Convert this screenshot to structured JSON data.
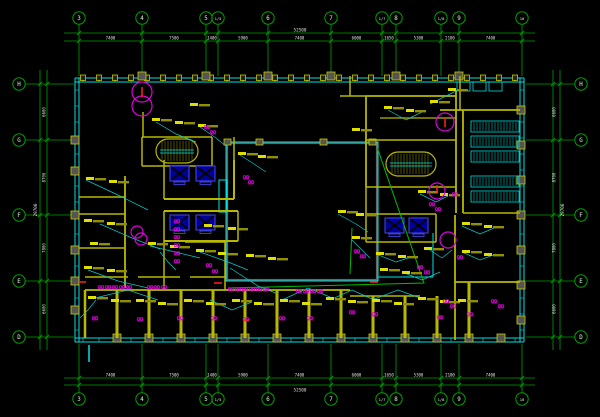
{
  "meta": {
    "title": "electrical-floor-plan",
    "width": 600,
    "height": 417
  },
  "colors": {
    "bg": "#000000",
    "grid": "#00a000",
    "bubble_text": "#ccffcc",
    "dim_text": "#e0e0e0",
    "wall": "#b8b800",
    "wall_bright": "#e0e000",
    "cyan": "#00e0e0",
    "magenta": "#e000e0",
    "blue": "#4848e8",
    "dark_blue": "#000099",
    "red": "#ff2222",
    "gray": "#666666",
    "green": "#00bb00",
    "tag": "#e0e000",
    "tag_dim": "#909000"
  },
  "grid": {
    "top_y": 18,
    "bottom_y": 399,
    "left_x": 19,
    "right_x": 581,
    "cols": [
      [
        "3",
        79
      ],
      [
        "4",
        142
      ],
      [
        "5",
        206
      ],
      [
        "1/5",
        218
      ],
      [
        "6",
        268
      ],
      [
        "7",
        331
      ],
      [
        "1/7",
        382
      ],
      [
        "8",
        396
      ],
      [
        "1/8",
        441
      ],
      [
        "9",
        459
      ],
      [
        "10",
        522
      ]
    ],
    "rows": [
      [
        "H",
        84
      ],
      [
        "G",
        140
      ],
      [
        "F",
        215
      ],
      [
        "E",
        281
      ],
      [
        "D",
        337
      ]
    ]
  },
  "dimensions": {
    "top_overall": "52500",
    "bottom_overall": "52500",
    "side_overall": "29700",
    "col_segments": [
      [
        "7400",
        79,
        142
      ],
      [
        "7500",
        142,
        206
      ],
      [
        "1400",
        206,
        218
      ],
      [
        "5900",
        218,
        268
      ],
      [
        "7400",
        268,
        331
      ],
      [
        "6000",
        331,
        382
      ],
      [
        "1650",
        382,
        396
      ],
      [
        "5300",
        396,
        441
      ],
      [
        "2100",
        441,
        459
      ],
      [
        "7400",
        459,
        522
      ]
    ],
    "row_segments": [
      [
        "6600",
        84,
        140
      ],
      [
        "8700",
        140,
        215
      ],
      [
        "7800",
        215,
        281
      ],
      [
        "6600",
        281,
        337
      ]
    ]
  },
  "building": {
    "outline": {
      "x1": 75,
      "y1": 78,
      "x2": 524,
      "y2": 342
    },
    "mullion_step": 16,
    "column_blocks": {
      "left_y": [
        140,
        171,
        215,
        250,
        281,
        310
      ],
      "right_y": [
        110,
        145,
        180,
        215,
        250,
        285,
        320
      ],
      "bottom_x": [
        117,
        149,
        181,
        213,
        245,
        277,
        309,
        341,
        373,
        405,
        437,
        469,
        501
      ],
      "top_x": [
        142,
        206,
        268,
        331,
        396,
        459
      ]
    }
  },
  "atrium": {
    "gray_rect": [
      227,
      143,
      150,
      137
    ],
    "cyan_rect": [
      226,
      142,
      152,
      139
    ],
    "ext_lines": [
      [
        378,
        277,
        433,
        277
      ],
      [
        433,
        233,
        433,
        277
      ]
    ],
    "notch": [
      219,
      180,
      8,
      32
    ],
    "squares_x": [
      224,
      256,
      320,
      369
    ],
    "squares_y": 139
  },
  "walls": [
    [
      143,
      112,
      143,
      137,
      1.5
    ],
    [
      142,
      137,
      212,
      137,
      1.5
    ],
    [
      142,
      137,
      142,
      166,
      1.5
    ],
    [
      212,
      137,
      212,
      166,
      1.5
    ],
    [
      142,
      166,
      212,
      166,
      1.5
    ],
    [
      164,
      160,
      164,
      199,
      1.5
    ],
    [
      234,
      160,
      234,
      199,
      2
    ],
    [
      164,
      199,
      234,
      199,
      2
    ],
    [
      234,
      137,
      234,
      160,
      1.5
    ],
    [
      164,
      211,
      238,
      211,
      2
    ],
    [
      164,
      211,
      164,
      241,
      1.5
    ],
    [
      238,
      211,
      238,
      241,
      1.5
    ],
    [
      164,
      241,
      238,
      241,
      2
    ],
    [
      164,
      241,
      164,
      290,
      1.5
    ],
    [
      125,
      176,
      125,
      288,
      1.8
    ],
    [
      79,
      197,
      125,
      197,
      1.5
    ],
    [
      79,
      214,
      125,
      214,
      1.5
    ],
    [
      79,
      248,
      125,
      248,
      1.5
    ],
    [
      185,
      242,
      225,
      242,
      1.5
    ],
    [
      225,
      242,
      225,
      290,
      1.5
    ],
    [
      85,
      290,
      350,
      290,
      1.8
    ],
    [
      85,
      290,
      85,
      338,
      2.5
    ],
    [
      117,
      290,
      117,
      338,
      3
    ],
    [
      149,
      290,
      149,
      338,
      3
    ],
    [
      181,
      290,
      181,
      338,
      3
    ],
    [
      213,
      290,
      213,
      338,
      3
    ],
    [
      245,
      290,
      245,
      338,
      3
    ],
    [
      277,
      290,
      277,
      338,
      3
    ],
    [
      309,
      290,
      309,
      338,
      3
    ],
    [
      341,
      290,
      341,
      338,
      3
    ],
    [
      85,
      277,
      128,
      277,
      1.5
    ],
    [
      138,
      277,
      180,
      277,
      1.5
    ],
    [
      190,
      277,
      225,
      277,
      1.5
    ],
    [
      350,
      296,
      420,
      296,
      1.5
    ],
    [
      373,
      296,
      373,
      338,
      3
    ],
    [
      405,
      296,
      405,
      338,
      3
    ],
    [
      437,
      296,
      437,
      338,
      3
    ],
    [
      469,
      282,
      469,
      338,
      3
    ],
    [
      366,
      96,
      456,
      96,
      1.8
    ],
    [
      366,
      96,
      366,
      187,
      1.8
    ],
    [
      456,
      90,
      456,
      213,
      1.8
    ],
    [
      366,
      140,
      456,
      140,
      1.5
    ],
    [
      366,
      187,
      456,
      187,
      1.5
    ],
    [
      380,
      118,
      456,
      118,
      1.2
    ],
    [
      350,
      76,
      350,
      96,
      1.5
    ],
    [
      340,
      96,
      366,
      96,
      1.5
    ],
    [
      366,
      214,
      436,
      214,
      1.5
    ],
    [
      366,
      214,
      366,
      242,
      1.5
    ],
    [
      436,
      214,
      436,
      242,
      1.5
    ],
    [
      366,
      242,
      436,
      242,
      1.5
    ],
    [
      366,
      187,
      366,
      214,
      1.5
    ],
    [
      440,
      110,
      520,
      110,
      1.8
    ],
    [
      463,
      110,
      463,
      213,
      1.8
    ],
    [
      463,
      213,
      520,
      213,
      1.5
    ],
    [
      460,
      76,
      460,
      110,
      1.5
    ],
    [
      455,
      215,
      455,
      340,
      1.8
    ],
    [
      455,
      282,
      520,
      282,
      1.8
    ]
  ],
  "stairs": [
    {
      "cx": 177,
      "cy": 151,
      "rx": 21,
      "ry": 12
    },
    {
      "cx": 411,
      "cy": 164,
      "rx": 25,
      "ry": 12
    }
  ],
  "elevators": [
    [
      170,
      166
    ],
    [
      196,
      166
    ],
    [
      170,
      215
    ],
    [
      196,
      215
    ],
    [
      385,
      218
    ],
    [
      409,
      218
    ]
  ],
  "racks": {
    "x": 471,
    "w": 48,
    "h": 11,
    "rows": [
      121,
      136,
      151,
      176,
      191
    ],
    "top_boxes": [
      [
        457,
        82,
        13,
        9
      ],
      [
        473,
        82,
        13,
        9
      ],
      [
        489,
        82,
        13,
        9
      ]
    ]
  },
  "green_feeder": [
    [
      [
        228,
        288
      ],
      [
        424,
        283
      ],
      [
        377,
        147
      ]
    ],
    [
      [
        352,
        228
      ],
      [
        350,
        274
      ]
    ]
  ],
  "wires": [
    [
      [
        86,
        180
      ],
      [
        120,
        196
      ],
      [
        148,
        210
      ]
    ],
    [
      [
        100,
        224
      ],
      [
        132,
        238
      ],
      [
        160,
        249
      ]
    ],
    [
      [
        88,
        270
      ],
      [
        118,
        281
      ],
      [
        148,
        288
      ]
    ],
    [
      [
        95,
        298
      ],
      [
        128,
        290
      ],
      [
        158,
        300
      ]
    ],
    [
      [
        150,
        246
      ],
      [
        175,
        252
      ],
      [
        200,
        258
      ]
    ],
    [
      [
        200,
        252
      ],
      [
        228,
        262
      ],
      [
        248,
        270
      ]
    ],
    [
      [
        230,
        268
      ],
      [
        258,
        286
      ],
      [
        278,
        294
      ]
    ],
    [
      [
        282,
        300
      ],
      [
        308,
        288
      ],
      [
        330,
        297
      ]
    ],
    [
      [
        330,
        300
      ],
      [
        352,
        290
      ],
      [
        372,
        299
      ]
    ],
    [
      [
        372,
        300
      ],
      [
        398,
        290
      ],
      [
        420,
        298
      ]
    ],
    [
      [
        156,
        122
      ],
      [
        176,
        134
      ],
      [
        196,
        142
      ]
    ],
    [
      [
        200,
        127
      ],
      [
        216,
        138
      ],
      [
        228,
        148
      ]
    ],
    [
      [
        338,
        214
      ],
      [
        356,
        224
      ],
      [
        368,
        232
      ]
    ],
    [
      [
        376,
        254
      ],
      [
        396,
        262
      ],
      [
        414,
        256
      ]
    ],
    [
      [
        402,
        272
      ],
      [
        422,
        280
      ],
      [
        440,
        272
      ]
    ],
    [
      [
        420,
        194
      ],
      [
        436,
        202
      ],
      [
        448,
        196
      ]
    ],
    [
      [
        388,
        110
      ],
      [
        406,
        120
      ],
      [
        422,
        112
      ]
    ],
    [
      [
        430,
        104
      ],
      [
        446,
        96
      ],
      [
        458,
        90
      ]
    ],
    [
      [
        462,
        226
      ],
      [
        480,
        234
      ],
      [
        494,
        228
      ]
    ],
    [
      [
        462,
        252
      ],
      [
        480,
        260
      ],
      [
        496,
        254
      ]
    ],
    [
      [
        240,
        155
      ],
      [
        254,
        164
      ],
      [
        266,
        172
      ]
    ],
    [
      [
        210,
        300
      ],
      [
        232,
        310
      ],
      [
        252,
        302
      ]
    ],
    [
      [
        96,
        300
      ],
      [
        88,
        310
      ],
      [
        80,
        318
      ]
    ],
    [
      [
        160,
        252
      ],
      [
        168,
        262
      ],
      [
        176,
        270
      ]
    ],
    [
      [
        352,
        240
      ],
      [
        362,
        250
      ],
      [
        370,
        258
      ]
    ],
    [
      [
        430,
        250
      ],
      [
        442,
        258
      ],
      [
        452,
        250
      ]
    ]
  ],
  "tags": [
    [
      86,
      177
    ],
    [
      109,
      180
    ],
    [
      84,
      219
    ],
    [
      107,
      222
    ],
    [
      84,
      266
    ],
    [
      107,
      269
    ],
    [
      90,
      242
    ],
    [
      88,
      296
    ],
    [
      111,
      299
    ],
    [
      136,
      299
    ],
    [
      158,
      302
    ],
    [
      184,
      299
    ],
    [
      206,
      302
    ],
    [
      232,
      299
    ],
    [
      254,
      302
    ],
    [
      280,
      299
    ],
    [
      302,
      302
    ],
    [
      326,
      297
    ],
    [
      348,
      300
    ],
    [
      372,
      299
    ],
    [
      394,
      302
    ],
    [
      418,
      297
    ],
    [
      440,
      300
    ],
    [
      458,
      299
    ],
    [
      148,
      242
    ],
    [
      170,
      245
    ],
    [
      196,
      249
    ],
    [
      218,
      252
    ],
    [
      246,
      254
    ],
    [
      268,
      257
    ],
    [
      204,
      224
    ],
    [
      228,
      227
    ],
    [
      152,
      118
    ],
    [
      175,
      121
    ],
    [
      198,
      124
    ],
    [
      190,
      103
    ],
    [
      338,
      210
    ],
    [
      356,
      213
    ],
    [
      352,
      236
    ],
    [
      376,
      252
    ],
    [
      398,
      255
    ],
    [
      424,
      247
    ],
    [
      380,
      268
    ],
    [
      402,
      271
    ],
    [
      418,
      190
    ],
    [
      440,
      193
    ],
    [
      384,
      106
    ],
    [
      406,
      109
    ],
    [
      430,
      100
    ],
    [
      352,
      128
    ],
    [
      462,
      222
    ],
    [
      484,
      225
    ],
    [
      462,
      250
    ],
    [
      484,
      253
    ],
    [
      448,
      88
    ],
    [
      238,
      152
    ],
    [
      258,
      155
    ]
  ],
  "outlets": [
    [
      101,
      287
    ],
    [
      108,
      287
    ],
    [
      115,
      287
    ],
    [
      122,
      287
    ],
    [
      129,
      287
    ],
    [
      150,
      287
    ],
    [
      157,
      287
    ],
    [
      164,
      287
    ],
    [
      231,
      289
    ],
    [
      238,
      289
    ],
    [
      245,
      289
    ],
    [
      252,
      289
    ],
    [
      259,
      289
    ],
    [
      266,
      289
    ],
    [
      299,
      291
    ],
    [
      306,
      291
    ],
    [
      313,
      291
    ],
    [
      320,
      291
    ],
    [
      177,
      221
    ],
    [
      177,
      229
    ],
    [
      177,
      237
    ],
    [
      177,
      245
    ],
    [
      177,
      253
    ],
    [
      177,
      261
    ],
    [
      209,
      265
    ],
    [
      215,
      271
    ],
    [
      246,
      177
    ],
    [
      251,
      182
    ],
    [
      207,
      127
    ],
    [
      213,
      132
    ],
    [
      95,
      318
    ],
    [
      140,
      319
    ],
    [
      180,
      318
    ],
    [
      214,
      318
    ],
    [
      246,
      319
    ],
    [
      282,
      318
    ],
    [
      310,
      318
    ],
    [
      352,
      312
    ],
    [
      375,
      314
    ],
    [
      440,
      317
    ],
    [
      470,
      314
    ],
    [
      357,
      251
    ],
    [
      363,
      256
    ],
    [
      420,
      267
    ],
    [
      427,
      272
    ],
    [
      446,
      301
    ],
    [
      453,
      306
    ],
    [
      460,
      257
    ],
    [
      494,
      301
    ],
    [
      501,
      306
    ],
    [
      432,
      204
    ],
    [
      438,
      209
    ],
    [
      455,
      194
    ]
  ],
  "magenta_circles": [
    {
      "cx": 142,
      "cy": 92,
      "r": 10
    },
    {
      "cx": 142,
      "cy": 106,
      "r": 10
    },
    {
      "cx": 445,
      "cy": 122,
      "r": 9
    },
    {
      "cx": 437,
      "cy": 191,
      "r": 8
    },
    {
      "cx": 137,
      "cy": 232,
      "r": 6
    },
    {
      "cx": 141,
      "cy": 239,
      "r": 6
    },
    {
      "cx": 448,
      "cy": 240,
      "r": 8
    }
  ],
  "red_marks": [
    [
      142,
      87,
      142,
      97
    ],
    [
      445,
      117,
      445,
      127
    ],
    [
      437,
      185,
      437,
      193
    ],
    [
      214,
      283,
      222,
      283
    ],
    [
      370,
      282,
      378,
      282
    ],
    [
      80,
      282,
      86,
      282
    ],
    [
      243,
      320,
      249,
      320
    ]
  ],
  "stray_cyan": [
    [
      89,
      345,
      89,
      362
    ]
  ]
}
